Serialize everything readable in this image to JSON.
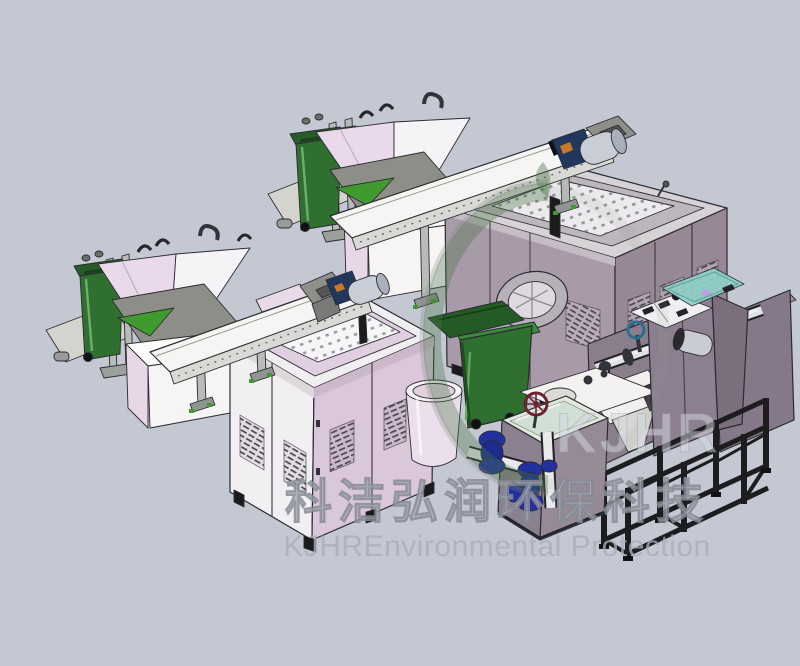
{
  "scene": {
    "type": "3d-cad-render",
    "subject": "Food waste treatment equipment production line, isometric CAD render",
    "background_color": "#c4c8d2",
    "edge_color": "#2b2b30",
    "components": [
      {
        "name": "feed-station-upper",
        "label": "bin lifter with green wheelie bin and feed hopper",
        "primary_color": "#2f7031"
      },
      {
        "name": "screw-conveyor-upper",
        "label": "inclined screw conveyor with drive motor",
        "primary_color": "#f5f5f3"
      },
      {
        "name": "crusher-machine",
        "label": "gray crusher/sorter with perforated top and round discharge chute",
        "primary_color": "#a89aa8"
      },
      {
        "name": "discharge-bin",
        "label": "open green wheelie bin under discharge chute",
        "primary_color": "#2f7031"
      },
      {
        "name": "feed-station-lower",
        "label": "second bin lifter with green wheelie bin and feed hopper",
        "primary_color": "#2f7031"
      },
      {
        "name": "screw-conveyor-lower",
        "label": "second inclined screw conveyor with drive motor",
        "primary_color": "#f5f5f3"
      },
      {
        "name": "dewatering-machine",
        "label": "white and lavender dewatering cabinet with louvered doors",
        "primary_color": "#f2eff2"
      },
      {
        "name": "collection-tub",
        "label": "round collection tub",
        "primary_color": "#ecdfec"
      },
      {
        "name": "oil-water-separator",
        "label": "oil-water separator with blue pumps and white piping",
        "primary_color": "#8b8090"
      },
      {
        "name": "piping-manifold",
        "label": "stainless piping manifold with valves",
        "primary_color": "#e9e9ec"
      },
      {
        "name": "support-frame",
        "label": "black steel support frame",
        "primary_color": "#1d1d1f"
      },
      {
        "name": "control-cabinet",
        "label": "control cabinet with teal glass cover and control panel",
        "primary_color": "#8c7f8f"
      }
    ],
    "palette": {
      "bin_green": "#2f7031",
      "hopper_pink": "#ead9ea",
      "machine_gray_purple": "#a89aa8",
      "cabinet_white": "#f2eff2",
      "cabinet_lavender": "#dac7da",
      "motor_silver": "#c9cdd6",
      "gearbox_blue": "#21375e",
      "gearbox_orange": "#c87a28",
      "pump_blue": "#2230a0",
      "glass_teal": "#8fd0c8",
      "frame_black": "#1d1d1f"
    }
  },
  "watermark": {
    "logo_letters": "KJHR",
    "cn_line": "科洁弘润环保科技",
    "en_line": "KJHREnvironmental Protection",
    "text_color": "#a9aeb8",
    "ring_green": "#4a7646"
  }
}
